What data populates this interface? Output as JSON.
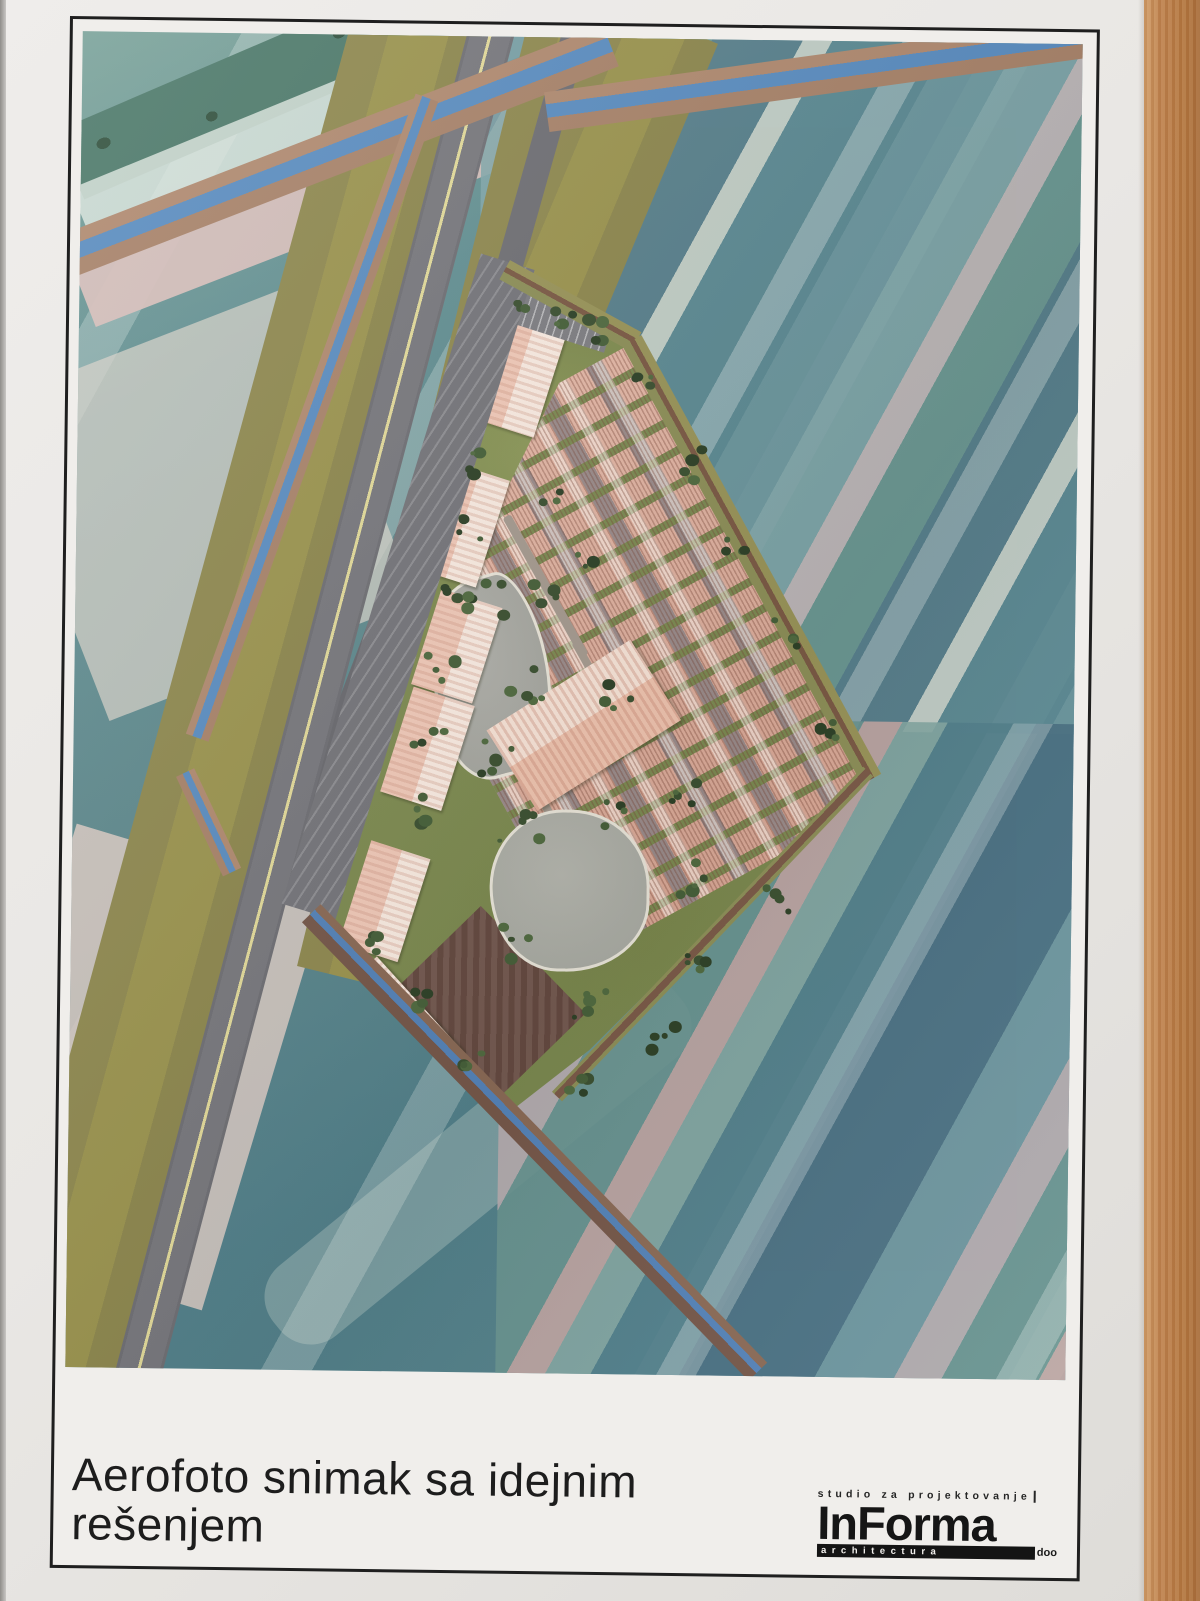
{
  "document": {
    "title": "Aerofoto snimak sa idejnim rešenjem",
    "logo": {
      "tagline": "studio za projektovanje",
      "name": "InForma",
      "field": "architectura",
      "suffix": "doo"
    }
  },
  "palette": {
    "paper": "#eae8e5",
    "wood_table": "#bf8450",
    "frame_border": "#1f1f1f",
    "field_teal": "#5f898d",
    "field_slate_blue": "#4a6f82",
    "field_pink": "#d3b6b2",
    "field_mint": "#dfe9e1",
    "verge_khaki": "#968f52",
    "road_grey": "#75757a",
    "road_centerline_yellow": "#e2da9a",
    "canal_blue": "#5b8dc0",
    "canal_bank_tan": "#ae8a6e",
    "site_lawn_green": "#83904f",
    "warehouse_roof_pink": "#f0c9b8",
    "warehouse_roof_white": "#f9ebe1",
    "rowhouse_pink": "#dcab9b",
    "pond_grey": "#a9aca4",
    "tilled_field_brown": "#6a4e44",
    "tree_green": "#3f5434"
  }
}
